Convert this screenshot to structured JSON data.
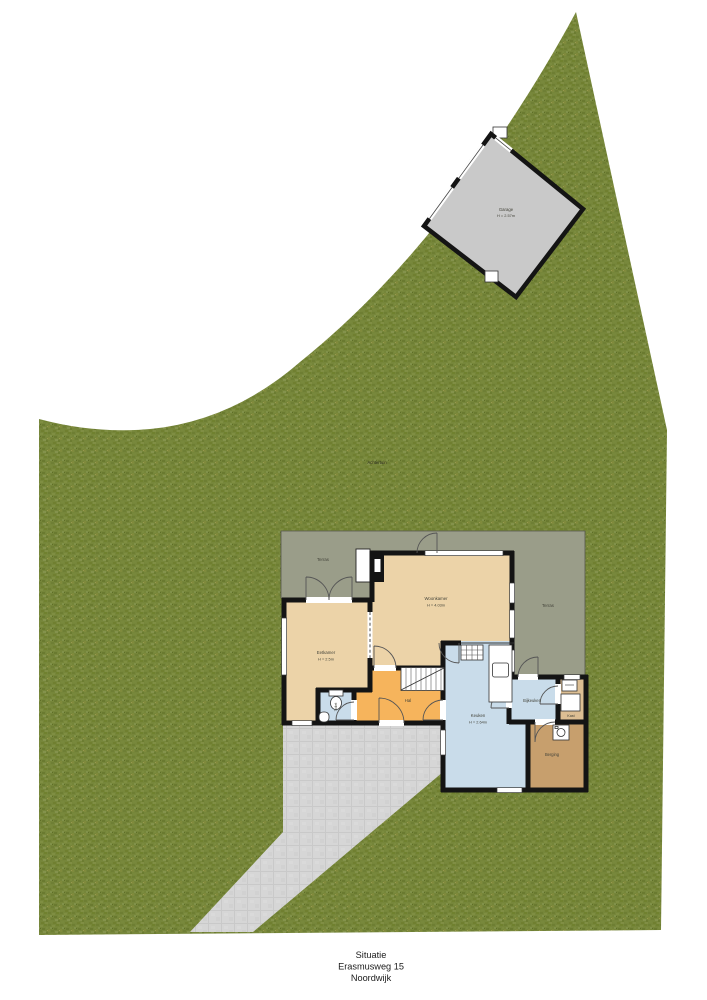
{
  "caption": {
    "line1": "Situatie",
    "line2": "Erasmusweg 15",
    "line3": "Noordwijk"
  },
  "site": {
    "garden_label": "Achtertuin"
  },
  "garage": {
    "label": "Garage",
    "height": "H = 2.57m"
  },
  "rooms": {
    "terras_left": {
      "label": "Terras"
    },
    "terras_right": {
      "label": "Terras"
    },
    "woonkamer": {
      "label": "Woonkamer",
      "height": "H = 4.03m"
    },
    "eetkamer": {
      "label": "Eetkamer",
      "height": "H = 2.5m"
    },
    "hal": {
      "label": "Hal"
    },
    "toilet": {
      "label": "Toilet"
    },
    "keuken": {
      "label": "Keuken",
      "height": "H = 2.64m"
    },
    "bijkeuken": {
      "label": "Bijkeuken"
    },
    "kast": {
      "label": "Kast"
    },
    "berging": {
      "label": "Berging"
    }
  },
  "colors": {
    "lawn": "#76863a",
    "paving": "#d6d6d6",
    "terrace": "#9a9d89",
    "room_tan": "#ecd3a8",
    "room_orange": "#f6b45c",
    "room_blue": "#c9dcea",
    "room_brown": "#c79f6d",
    "room_kast": "#dcbe93",
    "garage": "#c9c9c9",
    "wall": "#141414"
  }
}
